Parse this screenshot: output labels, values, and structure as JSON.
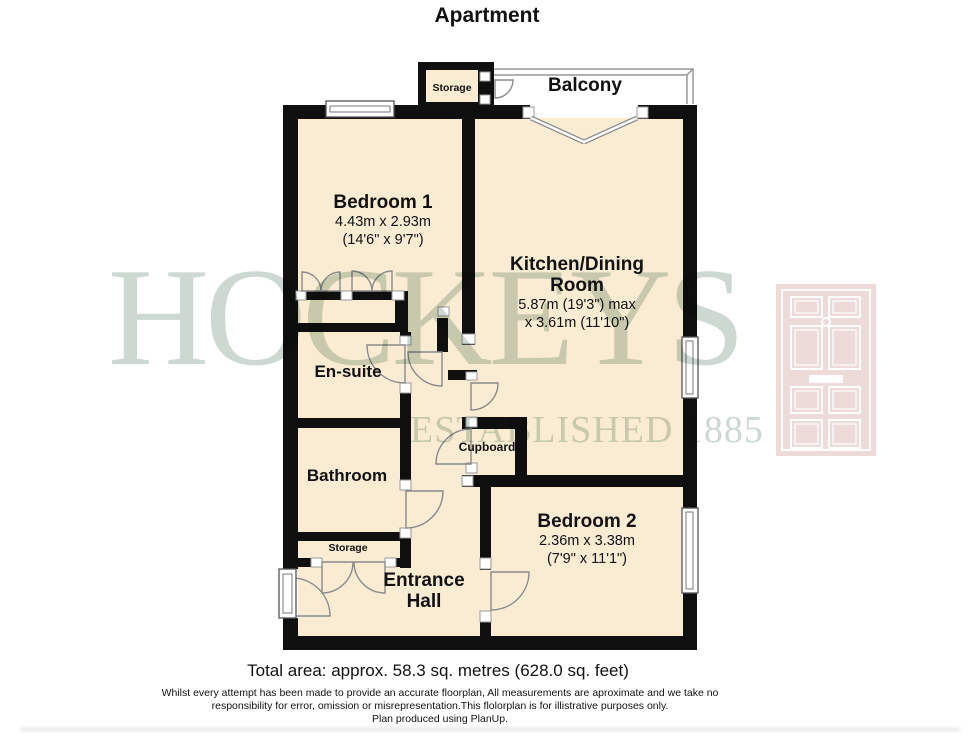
{
  "title": "Apartment",
  "colors": {
    "wall": "#0f0f0f",
    "floor": "#faecd3"
  },
  "watermark": {
    "brand": "HOCKEYS",
    "established": "ESTABLISHED 1885",
    "brand_color": "#ccd8d1",
    "door_logo_color": "#eddbd9"
  },
  "rooms": {
    "balcony": {
      "name": "Balcony"
    },
    "storage_top": {
      "name": "Storage"
    },
    "bedroom1": {
      "name": "Bedroom 1",
      "dim_metric": "4.43m x 2.93m",
      "dim_imperial": "(14'6\" x 9'7\")"
    },
    "kitchen": {
      "name": "Kitchen/Dining Room",
      "dim_line1": "5.87m (19'3\") max",
      "dim_line2": "x 3.61m (11'10\")"
    },
    "ensuite": {
      "name": "En-suite"
    },
    "bathroom": {
      "name": "Bathroom"
    },
    "cupboard": {
      "name": "Cupboard"
    },
    "storage_hall": {
      "name": "Storage"
    },
    "entrance_hall": {
      "name": "Entrance Hall"
    },
    "bedroom2": {
      "name": "Bedroom 2",
      "dim_metric": "2.36m x 3.38m",
      "dim_imperial": "(7'9\" x 11'1\")"
    }
  },
  "footer": {
    "total_area": "Total area: approx. 58.3 sq. metres (628.0 sq. feet)",
    "disclaimer_line1": "Whilst every attempt has been made to provide an accurate floorplan, All measurements are aproximate and we take no",
    "disclaimer_line2": "responsibility for error, omission or misrepresentation.This flolorplan is for illistrative purposes only.",
    "disclaimer_line3": "Plan produced using PlanUp."
  }
}
